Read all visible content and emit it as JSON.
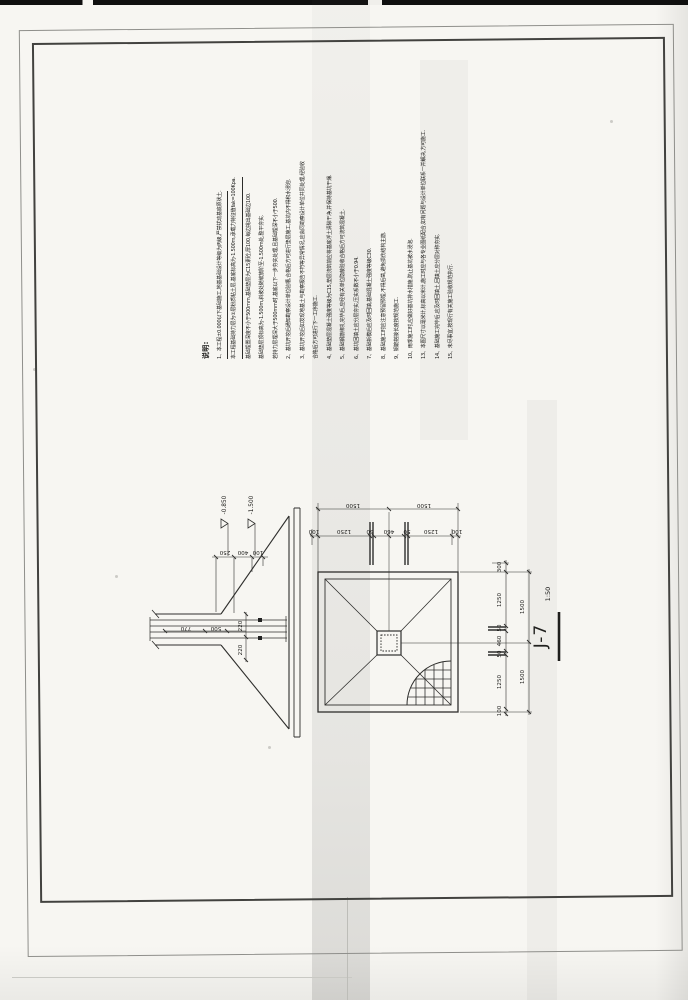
{
  "sheet": {
    "label": "J-7",
    "scale": "1:50"
  },
  "notes": {
    "title": "说明:",
    "lines": [
      {
        "text": "1、本工程±0.000以下基础施工,地基基础设计等级为丙级,严禁扰动基底原状土.",
        "u": true
      },
      {
        "text": "本工程基础持力层为②层粉质粘土层,基底标高为-1.500m,承载力特征值fak=100Kpa.",
        "u": true
      },
      {
        "text": "基础埋置深度不小于500mm,基础垫层为C15素砼,厚100,每边挑出基础边100.",
        "u": false
      },
      {
        "text": "基础垫层顶标高为-1.500m,斜坡处随坡放阶至-1.500m处,整平夯实.",
        "u": false
      },
      {
        "text": "若持力层埋深大于500mm时,基底以下一步夯实处理,且基础埋深不小于500.",
        "u": false
      },
      {
        "text": "2、基坑开挖后通知勘察设计单位验槽,合格后方可进行垫层施工,基坑内不得积水浸泡.",
        "u": false
      },
      {
        "text": "3、基坑开挖后如发现地基土与勘察报告不符等异常情况,应会同勘察设计单位共同处理,经验收",
        "u": false
      },
      {
        "text": "合格后方可进行下一工序施工.",
        "u": false
      },
      {
        "text": "4、基础垫层混凝土强度等级为C15,垫层浇筑前应将基底浮土清除干净,并保持基坑干燥.",
        "u": false
      },
      {
        "text": "5、基础钢筋绑扎完毕后,应经有关单位隐蔽验收合格后方可浇筑混凝土.",
        "u": false
      },
      {
        "text": "6、基坑回填土应分层夯实,压实系数不小于0.94.",
        "u": false
      },
      {
        "text": "7、基础拆模后应及时回填,基础混凝土强度等级C30.",
        "u": false
      },
      {
        "text": "8、基础施工时应注意预留预埋,不得后凿,避免损伤结构主筋.",
        "u": false
      },
      {
        "text": "9、钢筋搭接长度按规范施工.",
        "u": false
      },
      {
        "text": "10、雨季施工时,应做好基坑排水措施,防止基坑被水浸泡.",
        "u": false
      },
      {
        "text": "13、本图尺寸以毫米计,标高以米计,施工时应与各专业图纸配合,如有问题与设计单位联系一并解决,方可施工.",
        "u": false
      },
      {
        "text": "14、基础施工完毕后,应及时回填土,回填土应分层对称夯实.",
        "u": false
      },
      {
        "text": "15、未尽事宜,按现行有关施工验收规范执行.",
        "u": false
      }
    ]
  },
  "section": {
    "elev_top": "-0.850",
    "elev_bottom": "-1.500",
    "depth_chain": [
      "250",
      "400",
      "100"
    ],
    "wall_chain": [
      "770",
      "500"
    ],
    "column_chain": [
      "220",
      "220"
    ]
  },
  "plan": {
    "outer_top": [
      "1500",
      "1500"
    ],
    "inner_top": [
      "100",
      "1250",
      "50",
      "460",
      "50",
      "1250",
      "100"
    ],
    "inner_right": [
      "300",
      "1250",
      "50",
      "460",
      "50",
      "1250",
      "100"
    ],
    "outer_right": [
      "1500",
      "1500"
    ]
  }
}
